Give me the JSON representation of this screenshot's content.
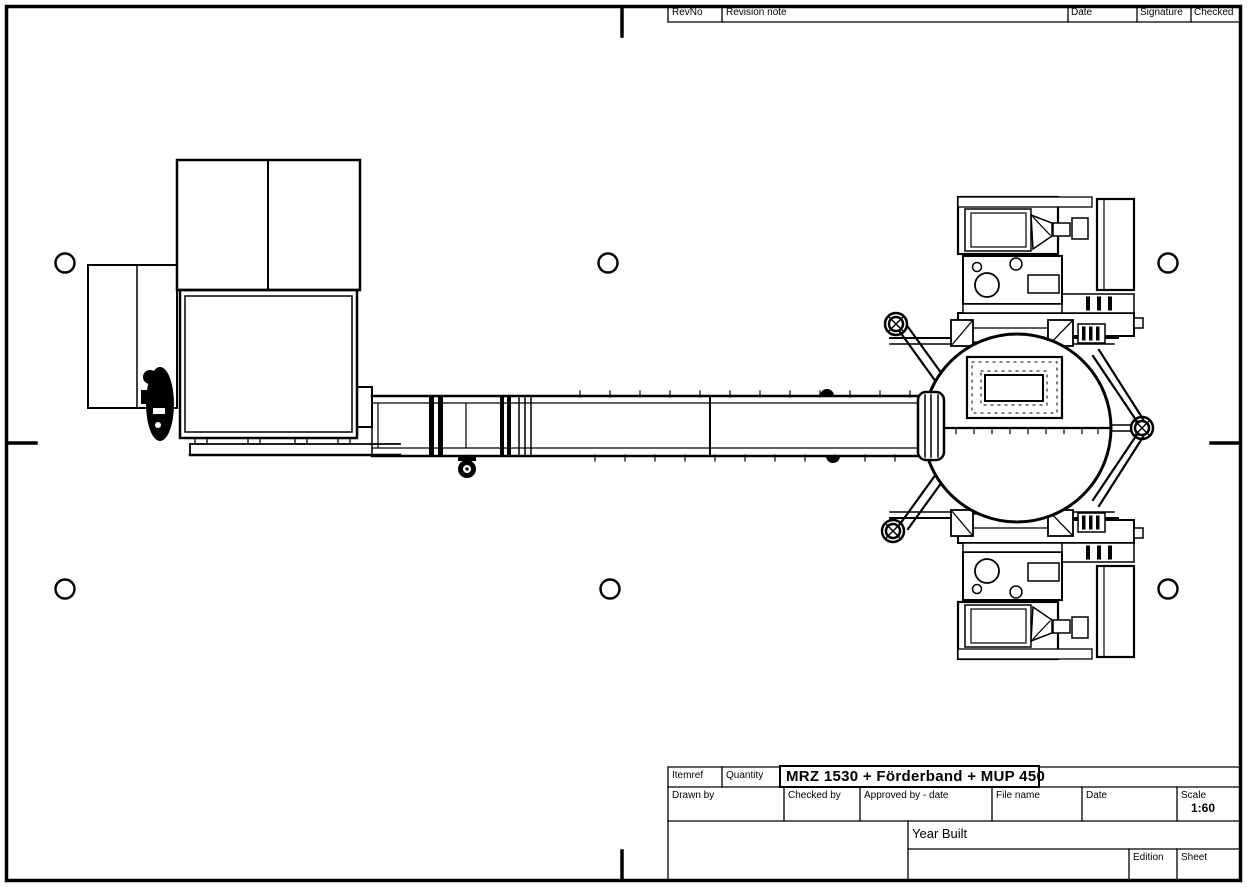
{
  "colors": {
    "ink": "#000000",
    "paper": "#ffffff"
  },
  "revision_table": {
    "headers": [
      "RevNo",
      "Revision note",
      "Date",
      "Signature",
      "Checked"
    ]
  },
  "title_block": {
    "itemref_label": "Itemref",
    "quantity_label": "Quantity",
    "drawing_title": "MRZ 1530 + Förderband + MUP 450",
    "drawn_by_label": "Drawn by",
    "checked_by_label": "Checked by",
    "approved_by_label": "Approved by - date",
    "file_name_label": "File name",
    "date_label": "Date",
    "scale_label": "Scale",
    "scale_value": "1:60",
    "year_built_label": "Year Built",
    "edition_label": "Edition",
    "sheet_label": "Sheet"
  },
  "drawing": {
    "machine_left": "MRZ 1530",
    "conveyor": "Förderband",
    "machine_right": "MUP 450"
  }
}
